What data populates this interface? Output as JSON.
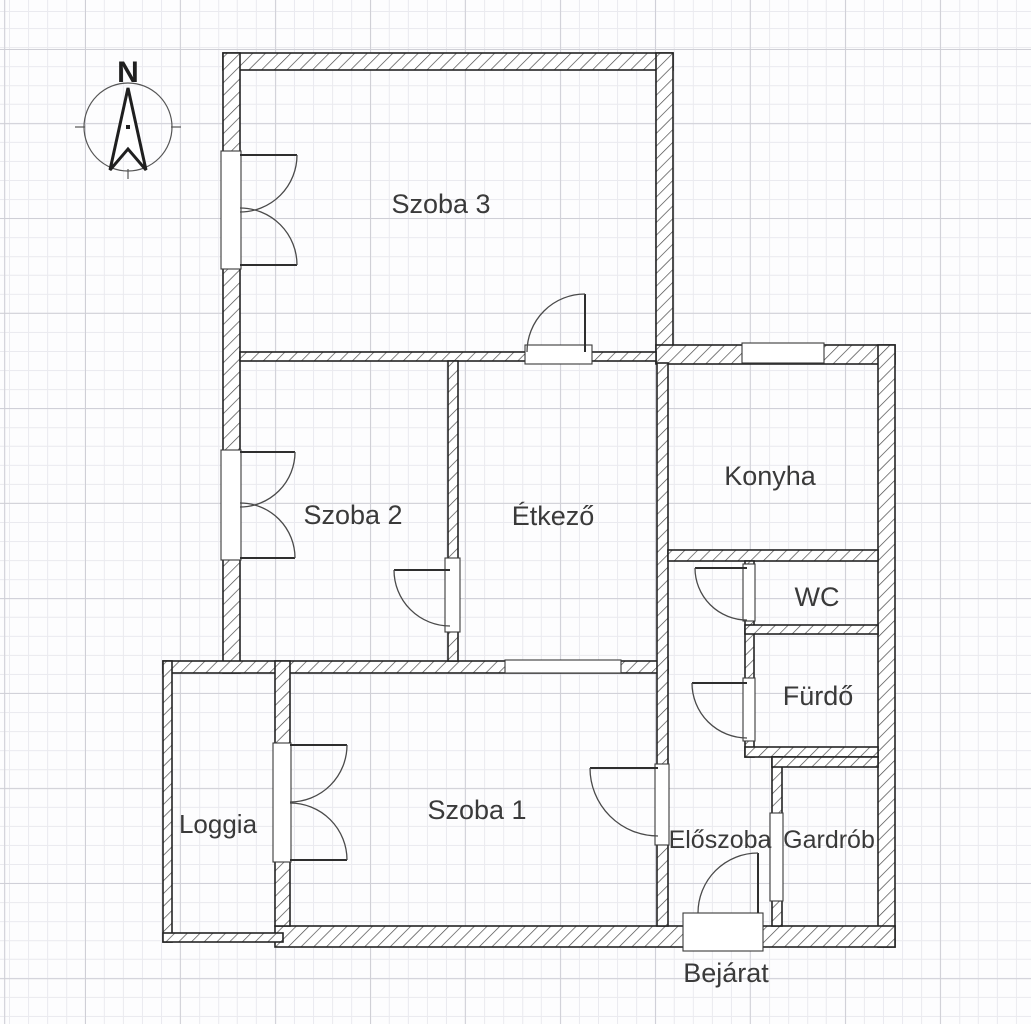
{
  "floorplan": {
    "title": "apartment-floor-plan",
    "compass": {
      "north_label": "N"
    },
    "rooms": [
      {
        "id": "szoba3",
        "label": "Szoba 3"
      },
      {
        "id": "szoba2",
        "label": "Szoba 2"
      },
      {
        "id": "etkezo",
        "label": "Étkező"
      },
      {
        "id": "konyha",
        "label": "Konyha"
      },
      {
        "id": "wc",
        "label": "WC"
      },
      {
        "id": "furdo",
        "label": "Fürdő"
      },
      {
        "id": "szoba1",
        "label": "Szoba 1"
      },
      {
        "id": "eloszoba",
        "label": "Előszoba"
      },
      {
        "id": "gardrob",
        "label": "Gardrób"
      },
      {
        "id": "loggia",
        "label": "Loggia"
      }
    ],
    "entrance_label": "Bejárat",
    "colors": {
      "wall_outline": "#242424",
      "wall_hatch": "#4a4a4a",
      "grid_minor": "#eaeaef",
      "grid_major": "#cfcfd6",
      "label_text": "#3a3a3a",
      "background": "#fdfdfe"
    }
  }
}
